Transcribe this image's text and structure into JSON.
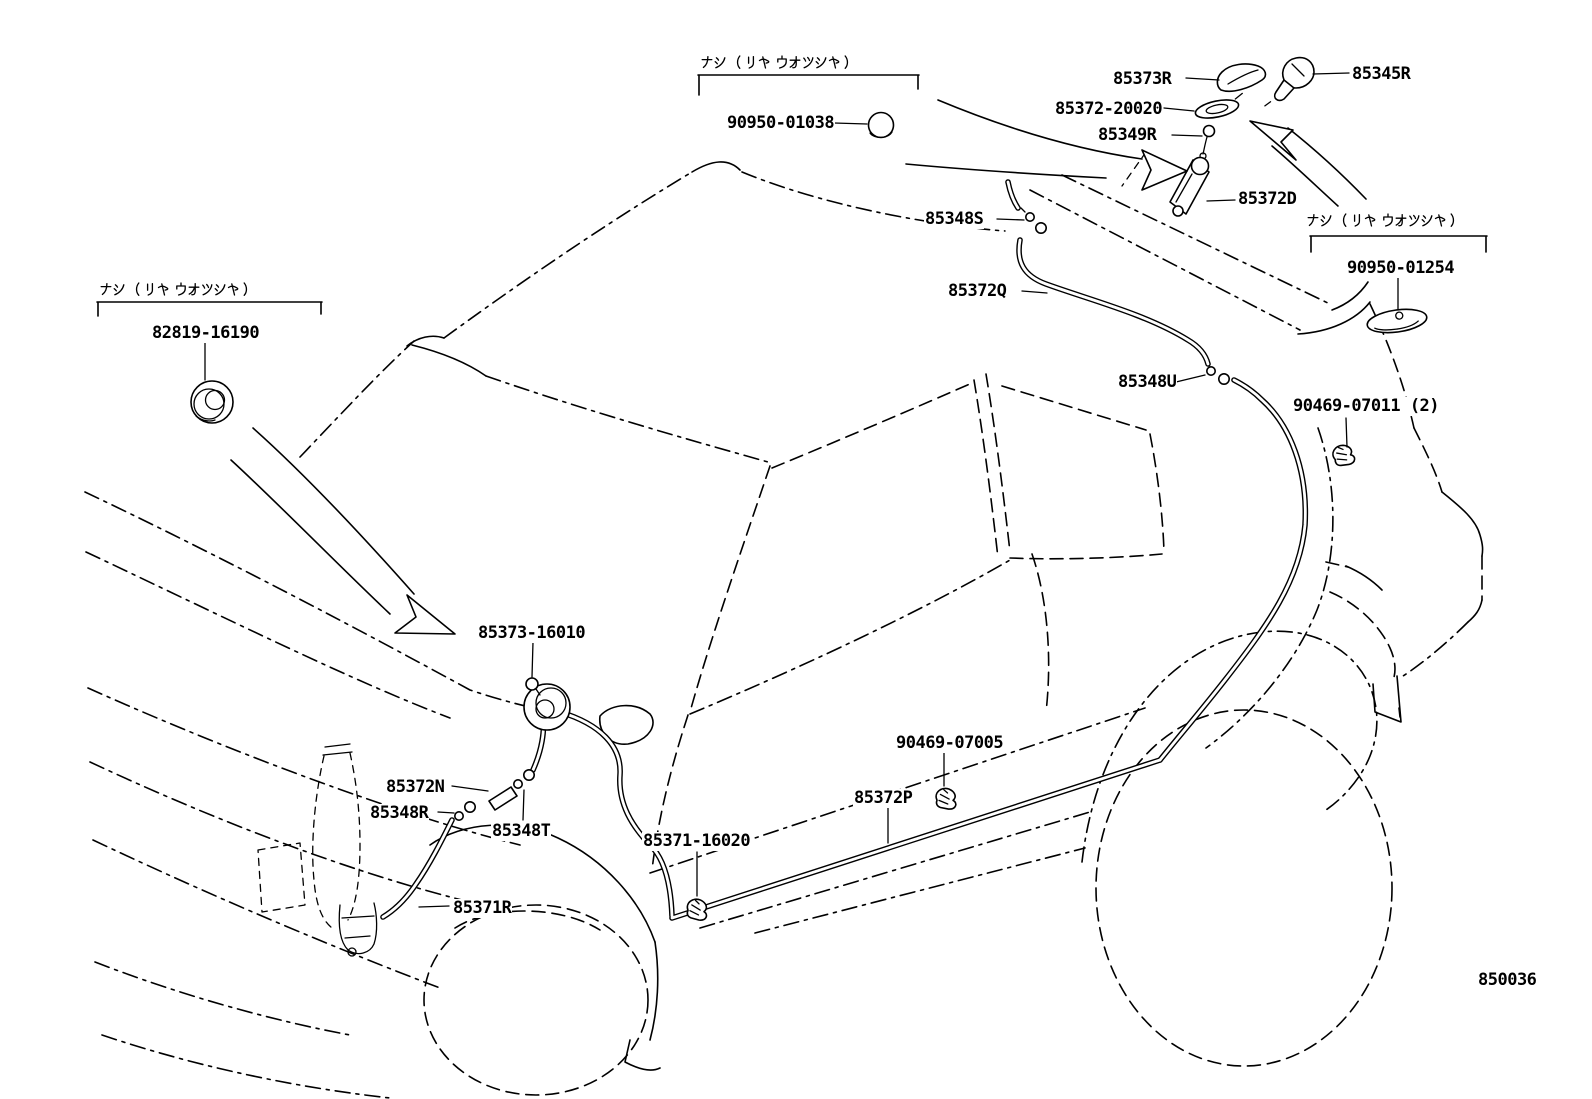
{
  "diagram": {
    "figure_number": "850036",
    "system_name": "rear washer hose routing",
    "notes": {
      "no_rear_washer": "ナシ (リヤ ウオツシヤ)"
    },
    "callouts": [
      {
        "part_number": "90950-01038"
      },
      {
        "part_number": "85373R"
      },
      {
        "part_number": "85345R"
      },
      {
        "part_number": "85372-20020"
      },
      {
        "part_number": "85349R"
      },
      {
        "part_number": "85372D"
      },
      {
        "part_number": "90950-01254"
      },
      {
        "part_number": "85348S"
      },
      {
        "part_number": "85372Q"
      },
      {
        "part_number": "85348U"
      },
      {
        "part_number": "90469-07011 (2)"
      },
      {
        "part_number": "82819-16190"
      },
      {
        "part_number": "85373-16010"
      },
      {
        "part_number": "85372N"
      },
      {
        "part_number": "85348R"
      },
      {
        "part_number": "85348T"
      },
      {
        "part_number": "85371-16020"
      },
      {
        "part_number": "90469-07005"
      },
      {
        "part_number": "85372P"
      },
      {
        "part_number": "85371R"
      }
    ]
  }
}
